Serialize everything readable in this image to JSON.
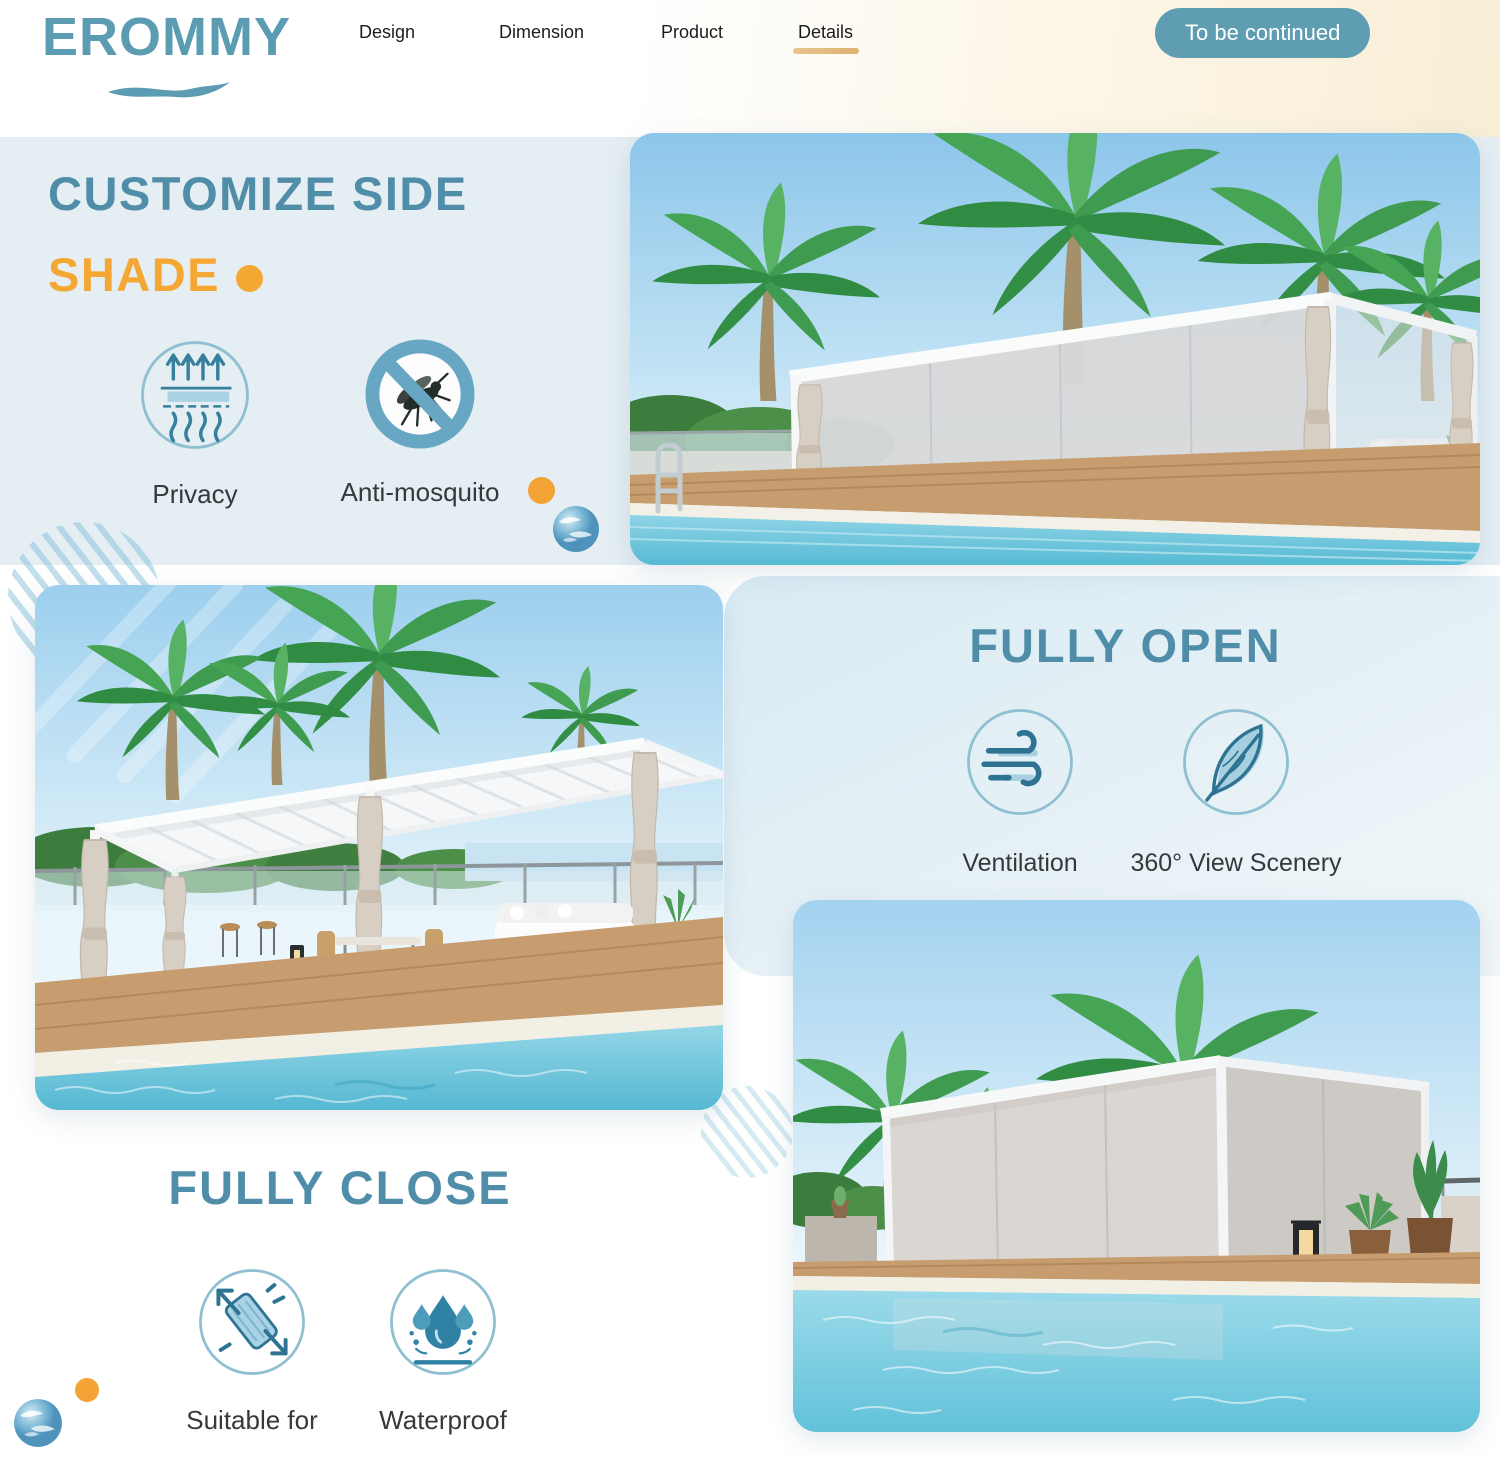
{
  "header": {
    "logo_text": "EROMMY",
    "nav_items": [
      {
        "label": "Design"
      },
      {
        "label": "Dimension"
      },
      {
        "label": "Product"
      },
      {
        "label": "Details"
      }
    ],
    "cta_label": "To be continued"
  },
  "customize_section": {
    "title_line1": "CUSTOMIZE SIDE",
    "title_line2": "SHADE",
    "features": [
      {
        "icon": "privacy-mesh-icon",
        "label": "Privacy"
      },
      {
        "icon": "no-mosquito-icon",
        "label": "Anti-mosquito"
      }
    ]
  },
  "fully_open_section": {
    "title": "FULLY OPEN",
    "features": [
      {
        "icon": "wind-icon",
        "label": "Ventilation"
      },
      {
        "icon": "feather-icon",
        "label": "360° View Scenery"
      }
    ]
  },
  "fully_close_section": {
    "title": "FULLY CLOSE",
    "features": [
      {
        "icon": "stretch-fabric-icon",
        "label": "Suitable for"
      },
      {
        "icon": "waterdrops-icon",
        "label": "Waterproof"
      }
    ]
  },
  "colors": {
    "brand_teal": "#4f8da9",
    "accent_orange": "#f5a733",
    "section_bg_blue": "#e4eef3",
    "button_bg": "#5f9db3"
  }
}
